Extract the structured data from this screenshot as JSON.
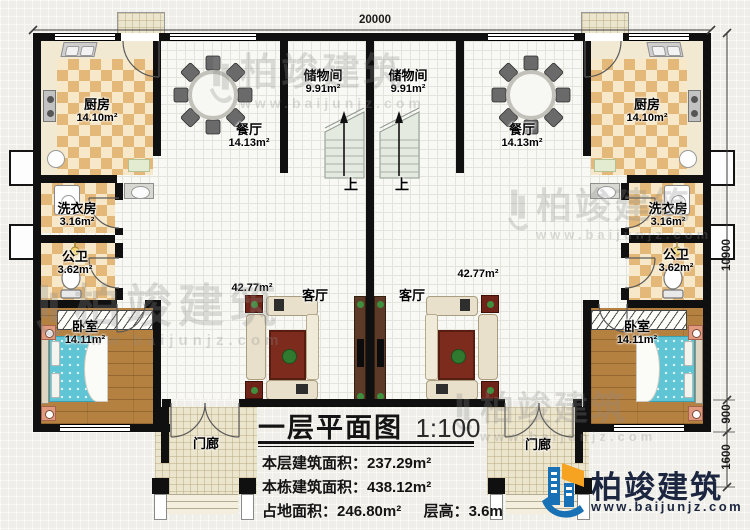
{
  "colors": {
    "wall": "#101010",
    "checker_tan": "#e4b878",
    "kitchen_cream": "#f2e9d3",
    "wood_floor": "#b58140",
    "bed_teal": "#5fc4d4",
    "rug_red": "#7c2b1d",
    "porch_tan": "#ece5cd",
    "stair_green": "#e5eae1",
    "brand_navy": "#1c2640",
    "brand_blue": "#1870b5",
    "brand_orange": "#f5a321",
    "watermark_grey": "#8b8b8b"
  },
  "dimensions": {
    "top": "20000",
    "right_total": "10900",
    "right_mid": "900",
    "right_bottom": "1600"
  },
  "rooms": {
    "kitchen_left": {
      "name": "厨房",
      "area": "14.10m²"
    },
    "kitchen_right": {
      "name": "厨房",
      "area": "14.10m²"
    },
    "dining_left": {
      "name": "餐厅",
      "area": "14.13m²"
    },
    "dining_right": {
      "name": "餐厅",
      "area": "14.13m²"
    },
    "storage_left": {
      "name": "储物间",
      "area": "9.91m²"
    },
    "storage_right": {
      "name": "储物间",
      "area": "9.91m²"
    },
    "laundry_left": {
      "name": "洗衣房",
      "area": "3.16m²"
    },
    "laundry_right": {
      "name": "洗衣房",
      "area": "3.16m²"
    },
    "bath_left": {
      "name": "公卫",
      "area": "3.62m²"
    },
    "bath_right": {
      "name": "公卫",
      "area": "3.62m²"
    },
    "bedroom_left": {
      "name": "卧室",
      "area": "14.11m²"
    },
    "bedroom_right": {
      "name": "卧室",
      "area": "14.11m²"
    },
    "living_left": {
      "name": "客厅",
      "area": "42.77m²"
    },
    "living_right": {
      "name": "客厅",
      "area": "42.77m²"
    },
    "porch_left": {
      "name": "门廊"
    },
    "porch_right": {
      "name": "门廊"
    },
    "stairs_left": {
      "up": "上"
    },
    "stairs_right": {
      "up": "上"
    }
  },
  "title_block": {
    "title": "一层平面图",
    "scale": "1:100",
    "line1_label": "本层建筑面积：",
    "line1_value": "237.29m²",
    "line2_label": "本栋建筑面积：",
    "line2_value": "438.12m²",
    "line3a_label": "占地面积：",
    "line3a_value": "246.80m²",
    "line3b_label": "层高：",
    "line3b_value": "3.6m"
  },
  "brand": {
    "name": "柏竣建筑",
    "url": "www.baijunjz.com"
  },
  "watermark": {
    "name": "柏竣建筑",
    "url": "www.baijunjz.com"
  }
}
